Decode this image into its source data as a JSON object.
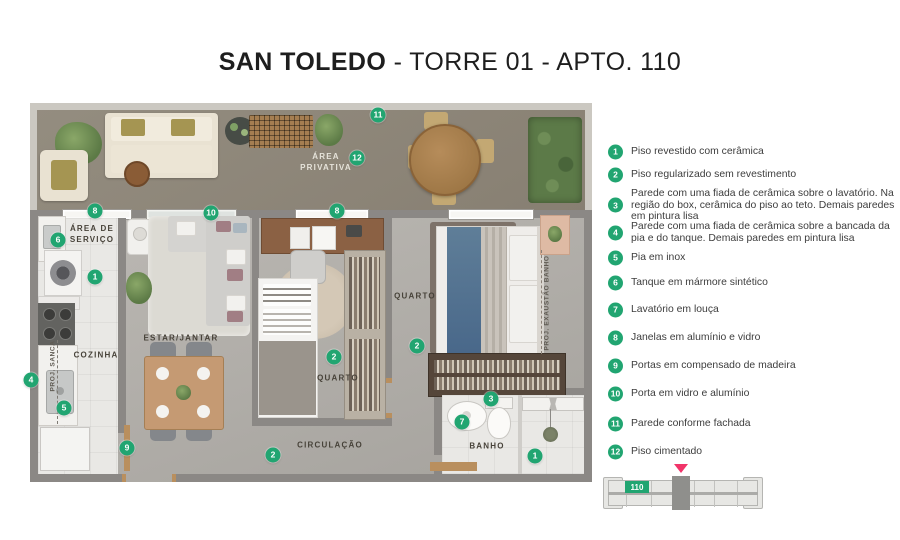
{
  "title": {
    "bold": "SAN TOLEDO",
    "regular": " - TORRE 01 - APTO. 110"
  },
  "colors": {
    "green": "#21A571",
    "pink": "#F13469"
  },
  "plan": {
    "labels": {
      "area_privativa_l1": "ÁREA",
      "area_privativa_l2": "PRIVATIVA",
      "area_servico_l1": "ÁREA DE",
      "area_servico_l2": "SERVIÇO",
      "cozinha": "COZINHA",
      "estar_jantar": "ESTAR/JANTAR",
      "quarto_mid": "QUARTO",
      "quarto_right": "QUARTO",
      "circulacao": "CIRCULAÇÃO",
      "banho": "BANHO",
      "proj_sanca": "PROJ. SANCA",
      "proj_exaustao": "PROJ. EXAUSTÃO BANHO"
    },
    "markers": {
      "m11": "11",
      "m12": "12",
      "m8a": "8",
      "m10": "10",
      "m8b": "8",
      "m6": "6",
      "m1a": "1",
      "m2a": "2",
      "m2b": "2",
      "m2c": "2",
      "m4": "4",
      "m5": "5",
      "m9": "9",
      "m3": "3",
      "m7": "7",
      "m1b": "1"
    }
  },
  "legend": {
    "items": [
      {
        "n": "1",
        "text": "Piso revestido com cerâmica"
      },
      {
        "n": "2",
        "text": "Piso regularizado sem revestimento"
      },
      {
        "n": "3",
        "text": "Parede com uma fiada de cerâmica sobre o lavatório. Na região do box, cerâmica do piso ao teto. Demais paredes em pintura lisa"
      },
      {
        "n": "4",
        "text": "Parede com uma fiada de cerâmica sobre a bancada da pia e  do tanque. Demais paredes em pintura lisa"
      },
      {
        "n": "5",
        "text": "Pia em inox"
      },
      {
        "n": "6",
        "text": "Tanque em mármore sintético"
      },
      {
        "n": "7",
        "text": "Lavatório em louça"
      },
      {
        "n": "8",
        "text": "Janelas em alumínio e vidro"
      },
      {
        "n": "9",
        "text": "Portas em compensado de madeira"
      },
      {
        "n": "10",
        "text": "Porta em vidro e alumínio"
      },
      {
        "n": "11",
        "text": "Parede  conforme fachada"
      },
      {
        "n": "12",
        "text": "Piso cimentado"
      }
    ]
  },
  "keyplan": {
    "unit": "110"
  }
}
